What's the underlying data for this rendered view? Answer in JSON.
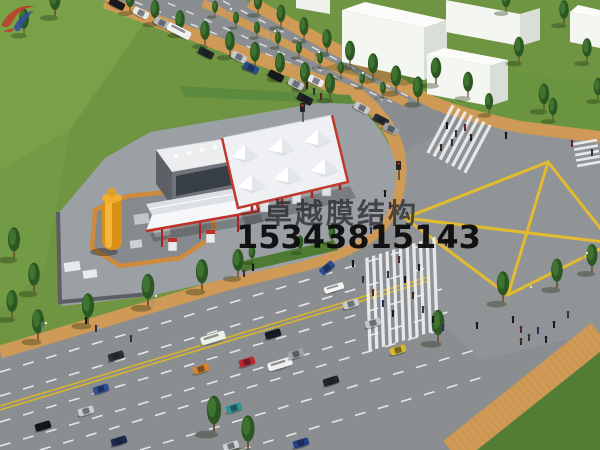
{
  "image": {
    "subject": "Aerial 3D rendering of a membrane-structure gas station at a city road intersection"
  },
  "watermark": {
    "logo_icon": "zhuoyue-membrane-logo",
    "company_name": "卓越膜结构",
    "phone_number": "15343815143"
  },
  "palette": {
    "grass_green": "#6f9542",
    "asphalt_grey": "#8b8e91",
    "sidewalk_tan": "#cf9a55",
    "marking_yellow": "#e2bb2e",
    "lane_white": "#eef0f1",
    "membrane_white": "#f2f4f6",
    "canopy_trim_red": "#c0392b",
    "tank_yellow": "#e8a520",
    "building_white": "#f4f6f2"
  }
}
